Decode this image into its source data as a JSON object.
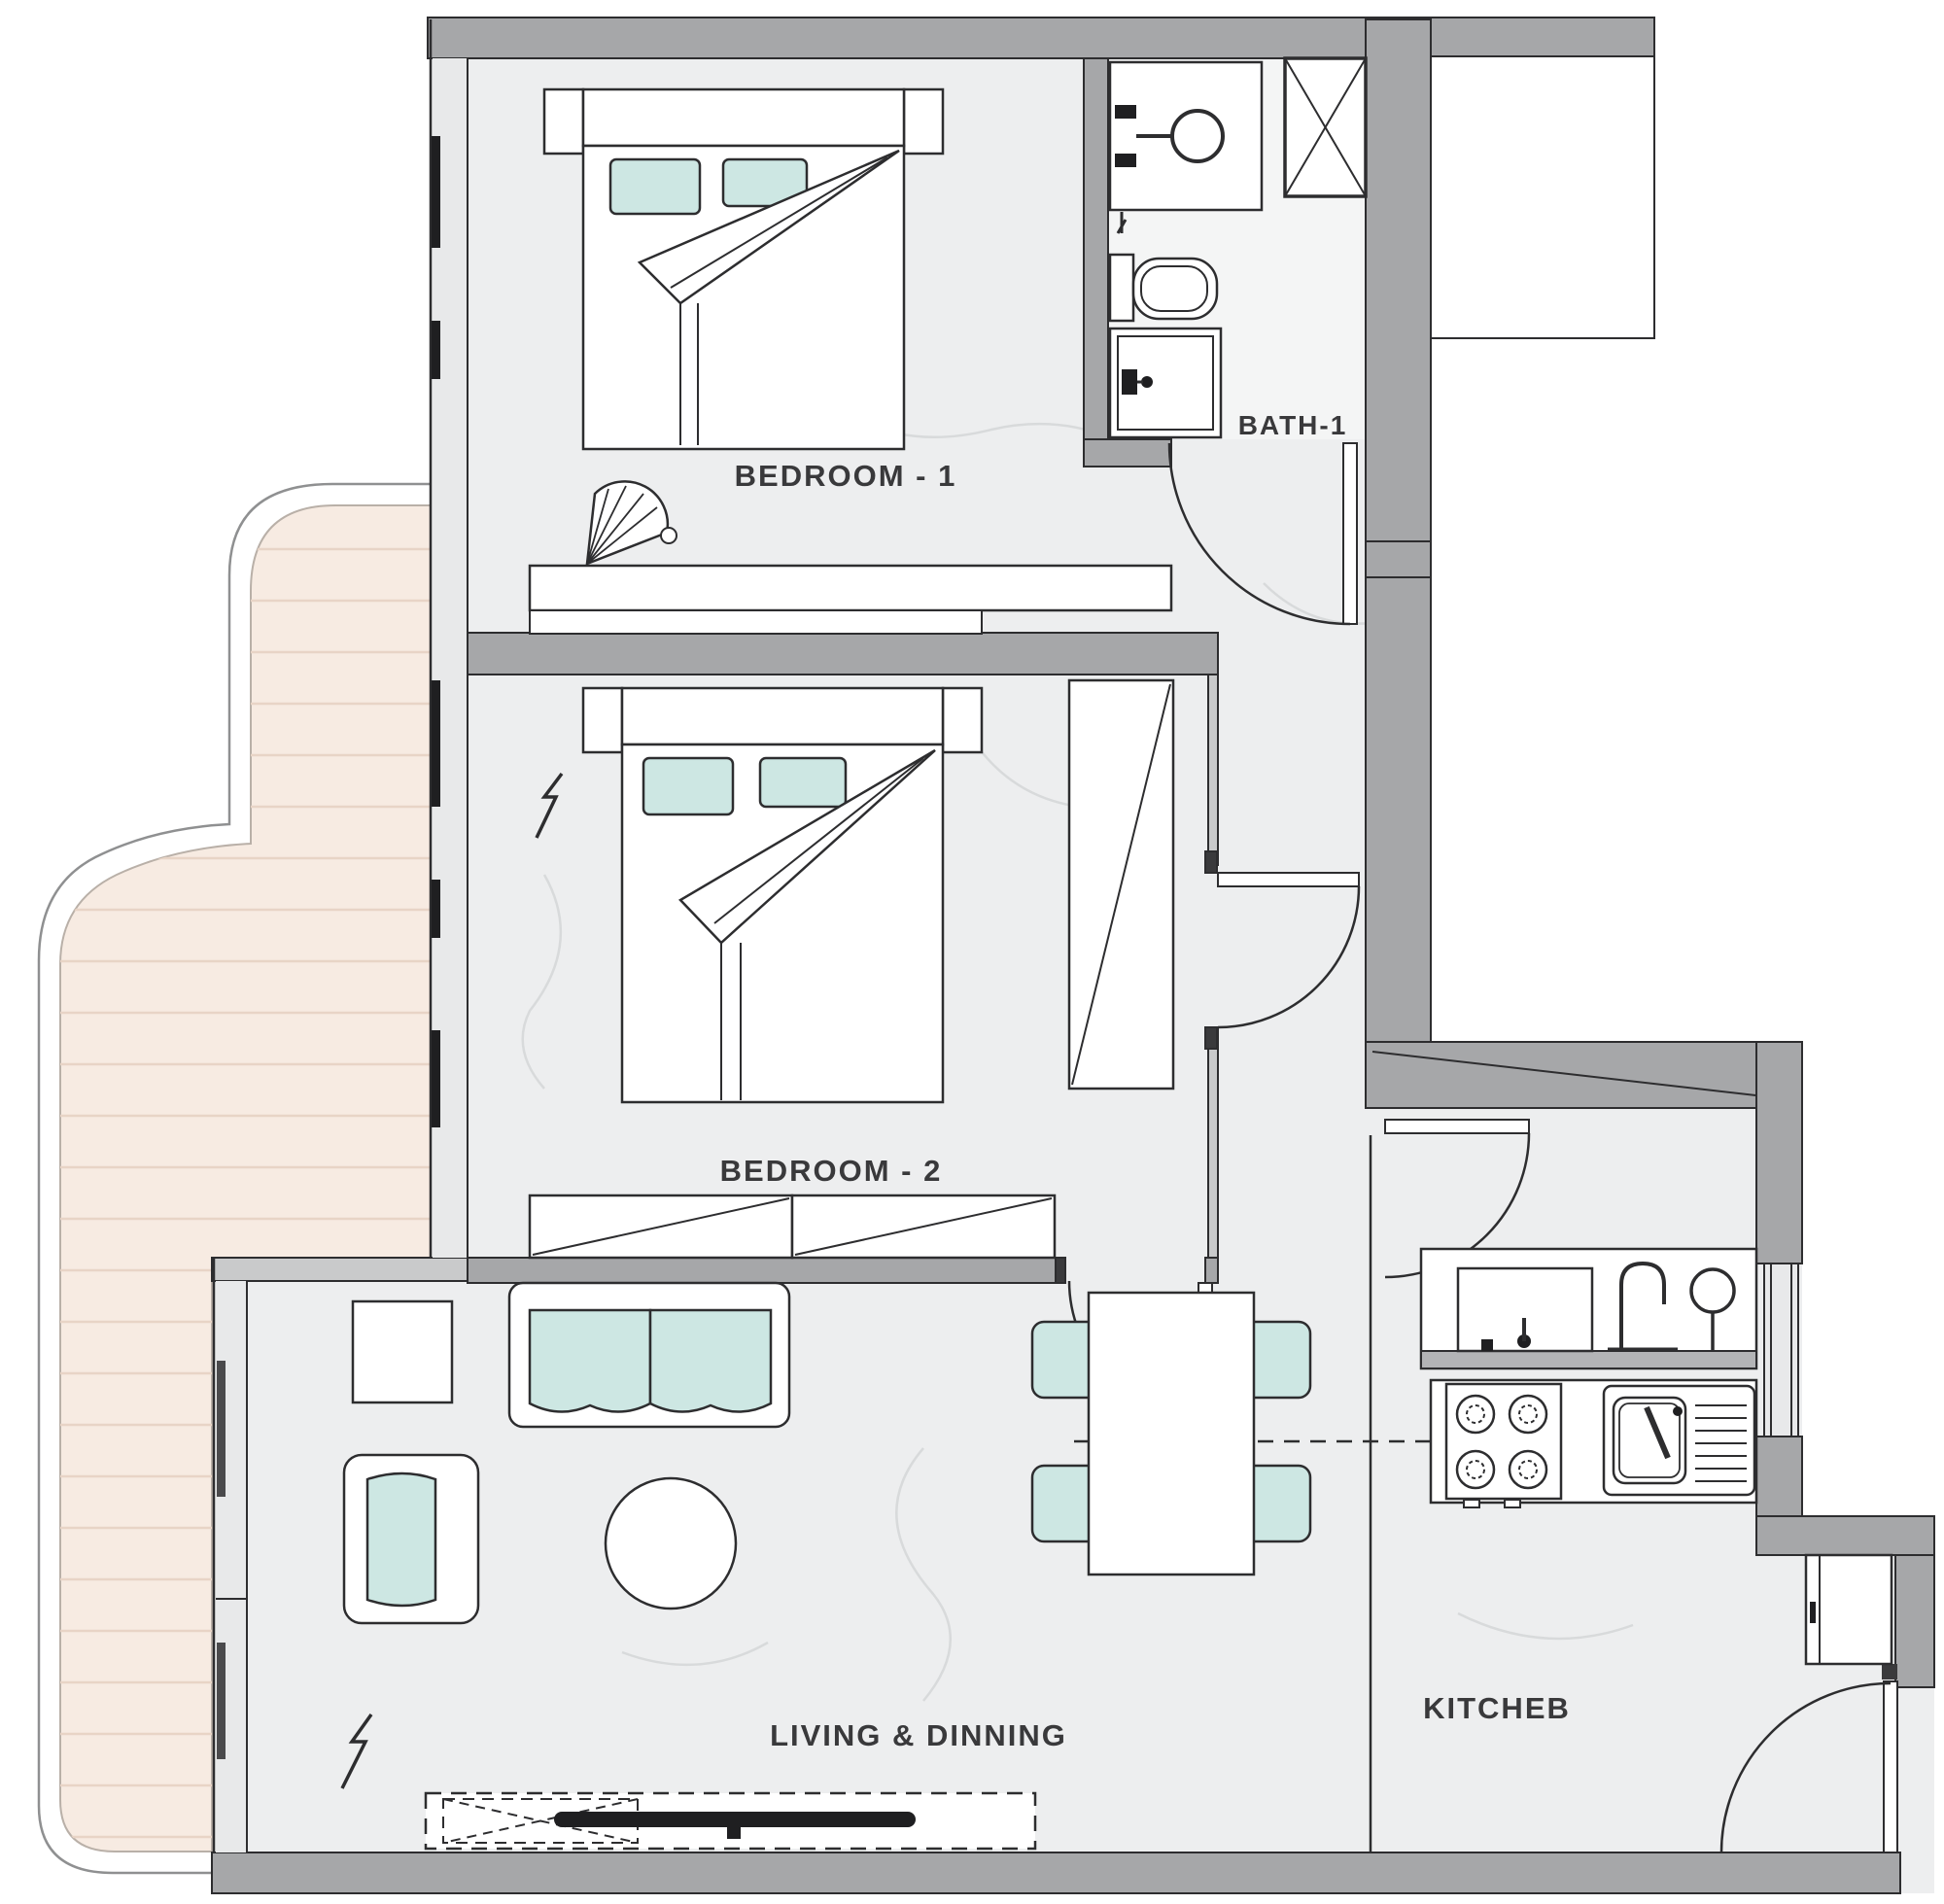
{
  "page": {
    "title": "Two Bedroom Apartment Floor Plan"
  },
  "rooms": {
    "bedroom1": {
      "label": "BEDROOM - 1"
    },
    "bedroom2": {
      "label": "BEDROOM - 2"
    },
    "bath1": {
      "label": "BATH-1"
    },
    "living_dining": {
      "label": "LIVING & DINNING"
    },
    "kitchen": {
      "label": "KITCHEB"
    }
  },
  "fixtures": [
    "double-bed-1",
    "double-bed-2",
    "wardrobe",
    "closet-band",
    "desk",
    "fan-chair",
    "vanity-sink",
    "toilet",
    "shower",
    "service-shaft",
    "sofa",
    "armchair",
    "side-table",
    "coffee-table",
    "tv-console",
    "tv",
    "dining-table",
    "dining-chairs",
    "gas-stove",
    "kitchen-sink",
    "counter",
    "fridge",
    "balcony-deck"
  ],
  "colors": {
    "wall": "#a6a7a9",
    "wall_outline": "#2d2d2f",
    "floor": "#edeeef",
    "floor_vein": "#d8dadb",
    "bath_floor": "#f4f5f5",
    "deck": "#f7ebe2",
    "deck_plank": "#e8d4c6",
    "cushion_teal": "#cde7e3",
    "glass_gray": "#e8e9ea",
    "label_text": "#39393b",
    "furniture_fill": "#ffffff"
  }
}
